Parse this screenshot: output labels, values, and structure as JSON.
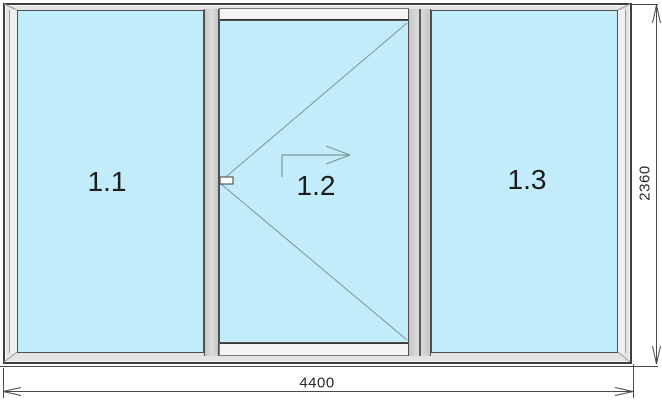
{
  "window_drawing": {
    "panels": [
      {
        "label": "1.1"
      },
      {
        "label": "1.2"
      },
      {
        "label": "1.3"
      }
    ],
    "dimensions": {
      "width": "4400",
      "height": "2360"
    },
    "colors": {
      "glass": "#c2ecfa",
      "frame": "#e4e4e4",
      "track": "#f4f4f4",
      "divider": "#cfcfcf",
      "outline": "#3f3f3f",
      "annotation_line": "#7d9696",
      "dimension_line": "#4a4a4a",
      "text": "#1c1c1c",
      "background": "#ffffff"
    }
  }
}
